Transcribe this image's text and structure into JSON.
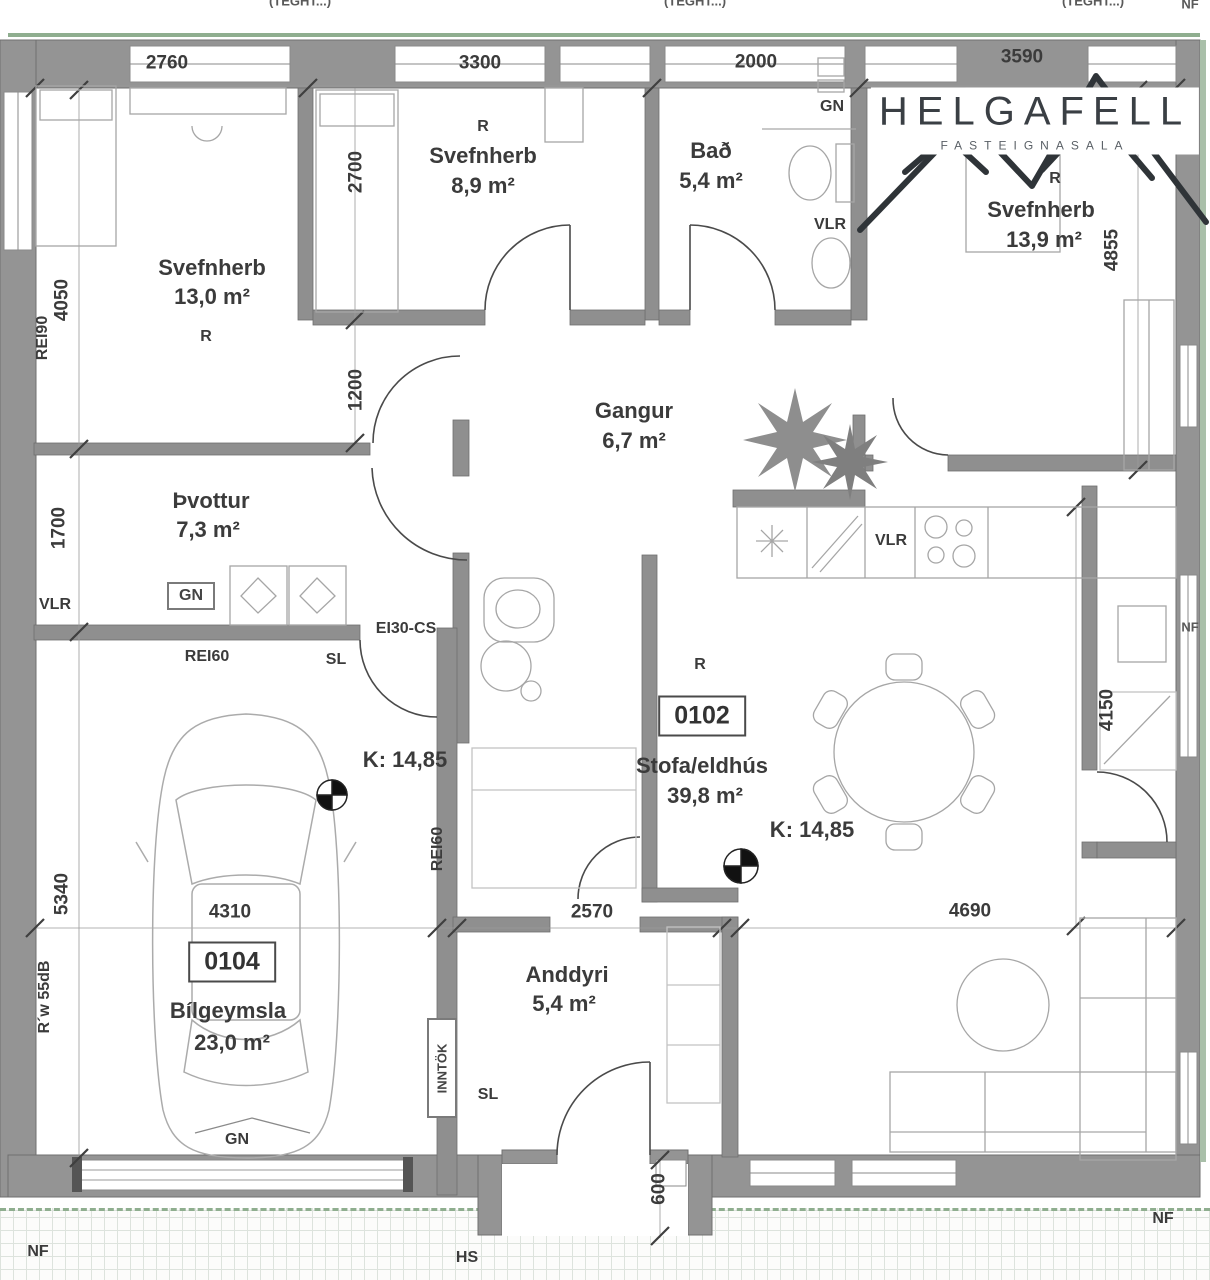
{
  "logo": {
    "name": "HELGAFELL",
    "tagline": "FASTEIGNASALA"
  },
  "rooms": {
    "svefnherb_nw": {
      "name": "Svefnherb",
      "area": "13,0 m²",
      "tag": "R"
    },
    "svefnherb_n": {
      "name": "Svefnherb",
      "area": "8,9 m²",
      "tag": "R"
    },
    "bad": {
      "name": "Bað",
      "area": "5,4 m²"
    },
    "svefnherb_ne": {
      "name": "Svefnherb",
      "area": "13,9 m²",
      "tag": "R"
    },
    "gangur": {
      "name": "Gangur",
      "area": "6,7 m²"
    },
    "thvottur": {
      "name": "Þvottur",
      "area": "7,3 m²"
    },
    "stofa_eldhus": {
      "name": "Stofa/eldhús",
      "area": "39,8 m²",
      "tag": "R",
      "unit": "0102",
      "level": "K: 14,85"
    },
    "bilgeymsla": {
      "name": "Bílgeymsla",
      "area": "23,0 m²",
      "unit": "0104",
      "level": "K: 14,85"
    },
    "anddyri": {
      "name": "Anddyri",
      "area": "5,4 m²"
    }
  },
  "dims": {
    "w2760": "2760",
    "w3300": "3300",
    "w2000": "2000",
    "w3590": "3590",
    "h4050": "4050",
    "h2700": "2700",
    "h1200": "1200",
    "h1700": "1700",
    "h5340": "5340",
    "h4855": "4855",
    "h4150": "4150",
    "w4310": "4310",
    "w2570": "2570",
    "w4690": "4690",
    "h600": "600"
  },
  "walls": {
    "rei90": "REI90",
    "rei60": "REI60",
    "ei30": "EI30-CS",
    "rw": "R´w 55dB"
  },
  "syms": {
    "gn": "GN",
    "vlr": "VLR",
    "sl": "SL",
    "inntok": "INNTÖK",
    "nf": "NF",
    "hs": "HS",
    "window_head": "(TEGHT...)"
  }
}
